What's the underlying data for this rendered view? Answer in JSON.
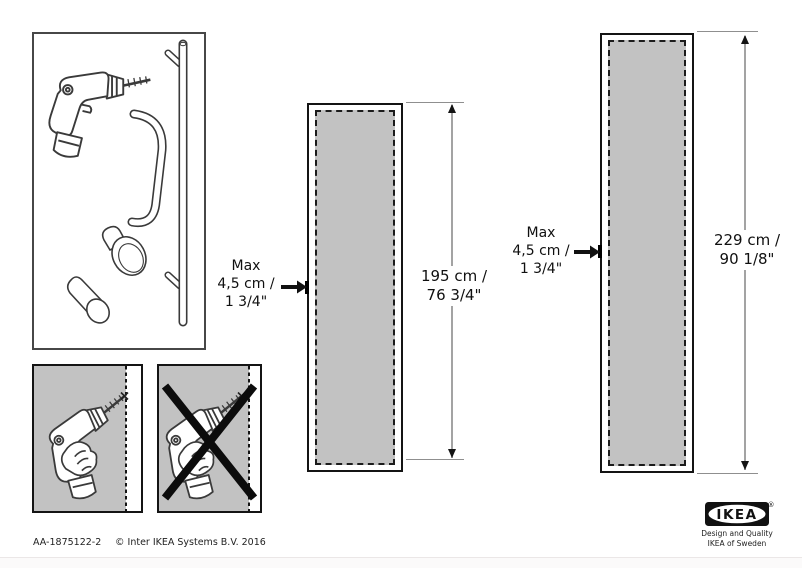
{
  "document": {
    "type": "assembly-instruction-sheet",
    "footer": {
      "doc_id": "AA-1875122-2",
      "copyright": "© Inter IKEA Systems B.V. 2016"
    }
  },
  "logo": {
    "wordmark": "IKEA",
    "registered": "®",
    "tagline1": "Design and Quality",
    "tagline2": "IKEA of Sweden"
  },
  "medium_panel": {
    "max_line1": "Max",
    "max_line2": "4,5 cm /",
    "max_line3": "1 3/4\"",
    "height_line1": "195 cm /",
    "height_line2": "76 3/4\""
  },
  "tall_panel": {
    "max_line1": "Max",
    "max_line2": "4,5 cm /",
    "max_line3": "1 3/4\"",
    "height_line1": "229 cm /",
    "height_line2": "90 1/8\""
  },
  "illustrations": {
    "parts_box_items": [
      "drill",
      "mounting-rail-with-pegs",
      "door-pull-handle",
      "round-knob",
      "cylinder-knob"
    ],
    "correct_drilling": "drill hole within max 4,5 cm edge zone",
    "incorrect_drilling": "drill hole beyond edge zone, crossed out"
  },
  "colors": {
    "panel_fill": "#c2c2c2",
    "line": "#141414",
    "dimension_shaft": "#a3a3a3",
    "background": "#ffffff"
  }
}
